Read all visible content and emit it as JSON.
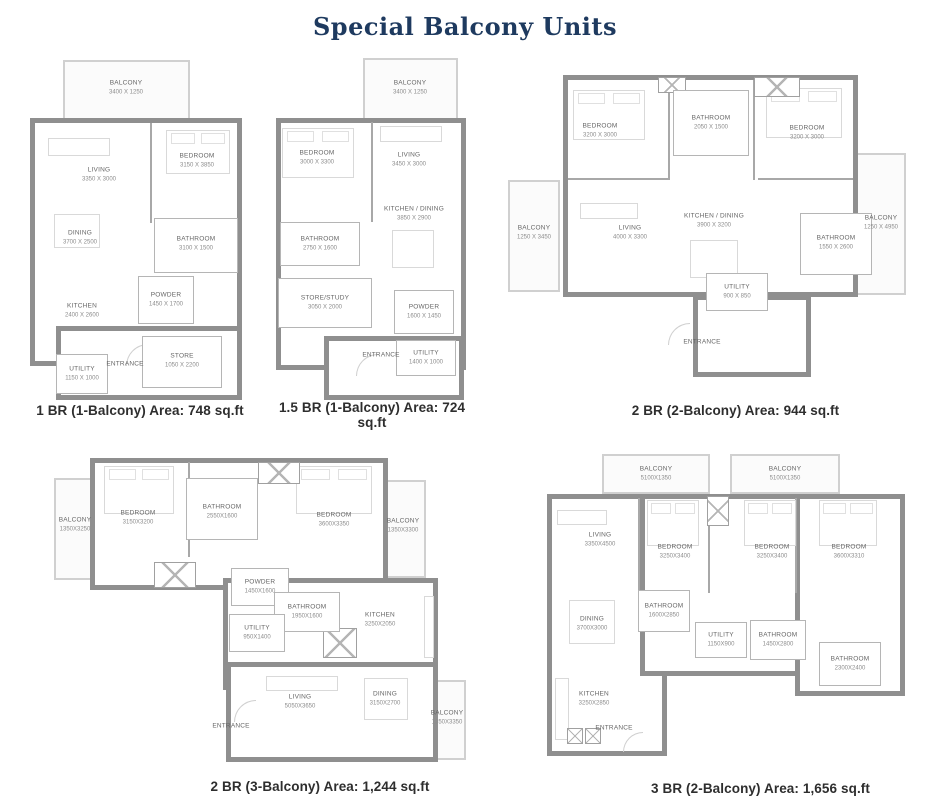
{
  "title": "Special Balcony Units",
  "colors": {
    "title_navy": "#1e3a5f",
    "wall_gray": "#8f8f8f",
    "caption_dark": "#2e2e2e"
  },
  "plans": [
    {
      "caption": "1 BR (1-Balcony) Area: 748 sq.ft",
      "rooms": {
        "balcony": {
          "name": "BALCONY",
          "dims": "3400 X 1250"
        },
        "living": {
          "name": "LIVING",
          "dims": "3350 X 3000"
        },
        "bedroom": {
          "name": "BEDROOM",
          "dims": "3150 X 3850"
        },
        "dining": {
          "name": "DINING",
          "dims": "3700 X 2500"
        },
        "bathroom": {
          "name": "BATHROOM",
          "dims": "3100 X 1500"
        },
        "kitchen": {
          "name": "KITCHEN",
          "dims": "2400 X 2600"
        },
        "powder": {
          "name": "POWDER",
          "dims": "1450 X 1700"
        },
        "store": {
          "name": "STORE",
          "dims": "1050 X 2200"
        },
        "utility": {
          "name": "UTILITY",
          "dims": "1150 X 1000"
        },
        "entrance": {
          "name": "ENTRANCE",
          "dims": ""
        }
      }
    },
    {
      "caption": "1.5 BR (1-Balcony) Area: 724 sq.ft",
      "rooms": {
        "balcony": {
          "name": "BALCONY",
          "dims": "3400 X 1250"
        },
        "bedroom": {
          "name": "BEDROOM",
          "dims": "3000 X 3300"
        },
        "living": {
          "name": "LIVING",
          "dims": "3450 X 3000"
        },
        "kitchen_dining": {
          "name": "KITCHEN / DINING",
          "dims": "3850 X 2900"
        },
        "bathroom": {
          "name": "BATHROOM",
          "dims": "2750 X 1600"
        },
        "store_study": {
          "name": "STORE/STUDY",
          "dims": "3050 X 2000"
        },
        "powder": {
          "name": "POWDER",
          "dims": "1600 X 1450"
        },
        "utility": {
          "name": "UTILITY",
          "dims": "1400 X 1000"
        },
        "entrance": {
          "name": "ENTRANCE",
          "dims": ""
        }
      }
    },
    {
      "caption": "2 BR (2-Balcony) Area: 944 sq.ft",
      "rooms": {
        "bedroom_left": {
          "name": "BEDROOM",
          "dims": "3200 X 3000"
        },
        "bathroom_top": {
          "name": "BATHROOM",
          "dims": "2050 X 1500"
        },
        "bedroom_right": {
          "name": "BEDROOM",
          "dims": "3200 X 3000"
        },
        "balcony_left": {
          "name": "BALCONY",
          "dims": "1250 X 3450"
        },
        "living": {
          "name": "LIVING",
          "dims": "4000 X 3300"
        },
        "kitchen_dining": {
          "name": "KITCHEN / DINING",
          "dims": "3900 X 3200"
        },
        "balcony_right": {
          "name": "BALCONY",
          "dims": "1250 X 4950"
        },
        "bathroom_right": {
          "name": "BATHROOM",
          "dims": "1550 X 2600"
        },
        "utility": {
          "name": "UTILITY",
          "dims": "900 X 850"
        },
        "entrance": {
          "name": "ENTRANCE",
          "dims": ""
        }
      }
    },
    {
      "caption": "2 BR (3-Balcony) Area: 1,244 sq.ft",
      "rooms": {
        "balcony_left": {
          "name": "BALCONY",
          "dims": "1350X3250"
        },
        "bedroom_left": {
          "name": "BEDROOM",
          "dims": "3150X3200"
        },
        "bathroom_top": {
          "name": "BATHROOM",
          "dims": "2550X1600"
        },
        "bedroom_right": {
          "name": "BEDROOM",
          "dims": "3600X3350"
        },
        "balcony_right": {
          "name": "BALCONY",
          "dims": "1350X3300"
        },
        "powder": {
          "name": "POWDER",
          "dims": "1450X1600"
        },
        "bathroom_mid": {
          "name": "BATHROOM",
          "dims": "1950X1600"
        },
        "utility": {
          "name": "UTILITY",
          "dims": "950X1400"
        },
        "kitchen": {
          "name": "KITCHEN",
          "dims": "3250X2050"
        },
        "living": {
          "name": "LIVING",
          "dims": "5050X3650"
        },
        "dining": {
          "name": "DINING",
          "dims": "3150X2700"
        },
        "balcony_bottom": {
          "name": "BALCONY",
          "dims": "1350X3350"
        },
        "entrance": {
          "name": "ENTRANCE",
          "dims": ""
        }
      }
    },
    {
      "caption": "3 BR (2-Balcony) Area: 1,656 sq.ft",
      "rooms": {
        "balcony_1": {
          "name": "BALCONY",
          "dims": "5100X1350"
        },
        "balcony_2": {
          "name": "BALCONY",
          "dims": "5100X1350"
        },
        "living": {
          "name": "LIVING",
          "dims": "3350X4500"
        },
        "bedroom_1": {
          "name": "BEDROOM",
          "dims": "3250X3400"
        },
        "bedroom_2": {
          "name": "BEDROOM",
          "dims": "3250X3400"
        },
        "bedroom_3": {
          "name": "BEDROOM",
          "dims": "3600X3310"
        },
        "dining": {
          "name": "DINING",
          "dims": "3700X3000"
        },
        "bathroom_1": {
          "name": "BATHROOM",
          "dims": "1600X2850"
        },
        "utility": {
          "name": "UTILITY",
          "dims": "1150X900"
        },
        "bathroom_2": {
          "name": "BATHROOM",
          "dims": "1450X2800"
        },
        "bathroom_3": {
          "name": "BATHROOM",
          "dims": "2300X2400"
        },
        "kitchen": {
          "name": "KITCHEN",
          "dims": "3250X2850"
        },
        "entrance": {
          "name": "ENTRANCE",
          "dims": ""
        }
      }
    }
  ]
}
